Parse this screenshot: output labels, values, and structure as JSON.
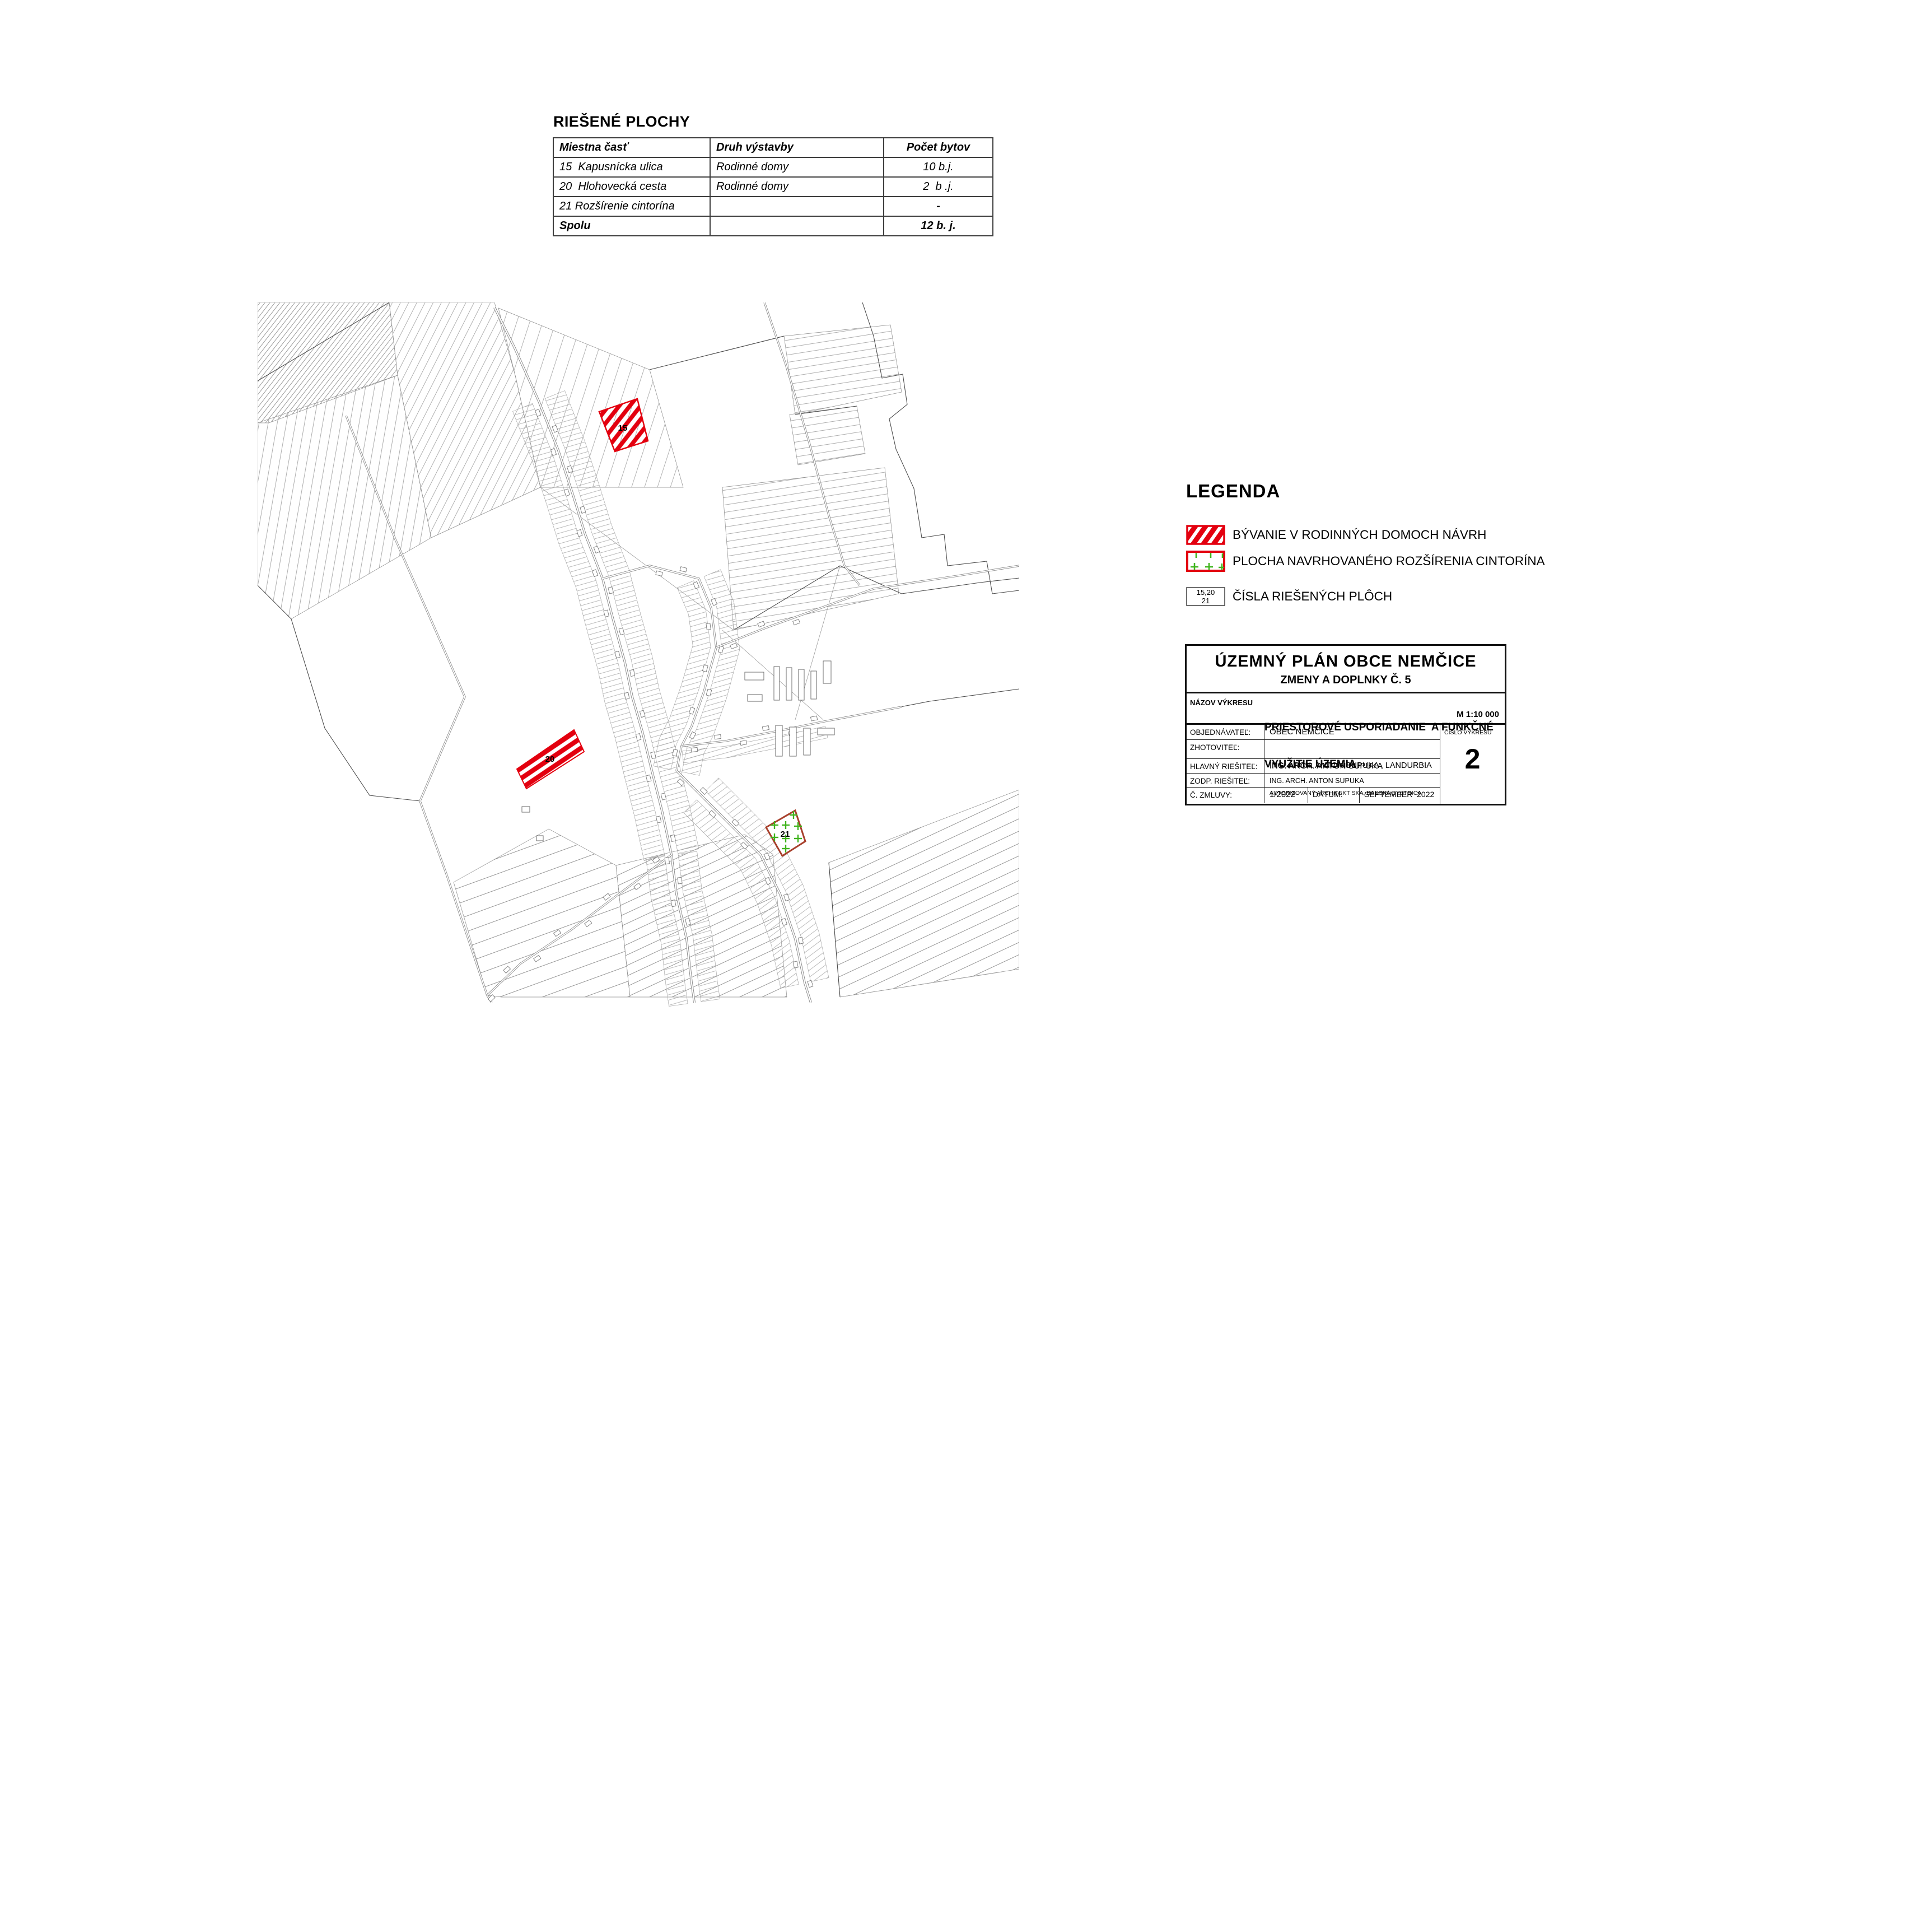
{
  "table": {
    "title": "RIEŠENÉ PLOCHY",
    "headers": [
      "Miestna časť",
      "Druh výstavby",
      "Počet bytov"
    ],
    "rows": [
      [
        "15  Kapusnícka ulica",
        "Rodinné domy",
        "10 b.j."
      ],
      [
        "20  Hlohovecká cesta",
        "Rodinné domy",
        "2  b .j."
      ],
      [
        "21 Rozšírenie cintorína",
        "",
        "-"
      ],
      [
        "Spolu",
        "",
        "12 b. j."
      ]
    ]
  },
  "map": {
    "labels": {
      "a15": "15",
      "a20": "20",
      "a21": "21"
    },
    "colors": {
      "proposal_red": "#e3000f",
      "cemetery_outline": "#a8402c",
      "cemetery_green": "#3fb41c",
      "parcel_line": "#787878"
    }
  },
  "legend": {
    "title": "LEGENDA",
    "items": [
      {
        "swatch": "red-diagonal-hatch",
        "label": "BÝVANIE V RODINNÝCH DOMOCH NÁVRH"
      },
      {
        "swatch": "red-box-green-crosses",
        "label": "PLOCHA NAVRHOVANÉHO ROZŠÍRENIA CINTORÍNA"
      },
      {
        "swatch": "numbers-box",
        "numbers_top": "15,20",
        "numbers_bottom": "21",
        "label": "ČÍSLA RIEŠENÝCH PLÔCH"
      }
    ]
  },
  "title_block": {
    "title": "ÚZEMNÝ PLÁN OBCE NEMČICE",
    "subtitle": "ZMENY A DOPLNKY Č. 5",
    "name_label": "NÁZOV VÝKRESU",
    "name_line1": "PRIESTOROVÉ USPORIADANIE  A FUNKČNÉ",
    "name_line2": "VYUŽITIE ÚZEMIA",
    "scale": "M 1:10 000",
    "rows": [
      {
        "label": "OBJEDNÁVATEĽ:",
        "value": "OBEC NEMČICE"
      },
      {
        "label": "ZHOTOVITEĽ:",
        "value": "ING. ARCH. ANTON SUPUKA , LANDURBIA",
        "value2": "AUTORIZOVANÝ ARCHITEKT SKA, BANSKÁ BYSTRICA"
      },
      {
        "label": "HLAVNÝ RIEŠITEĽ:",
        "value": "ING. ARCH. ANTON SUPUKA"
      },
      {
        "label": "ZODP. RIEŠITEĽ:",
        "value": "ING. ARCH. ANTON SUPUKA"
      },
      {
        "label": "Č. ZMLUVY:",
        "value": "1/2022",
        "date_label": "DÁTUM:",
        "date_value": "SEPTEMBER  2022"
      }
    ],
    "number_label": "ČÍSLO VÝKRESU",
    "number": "2"
  }
}
